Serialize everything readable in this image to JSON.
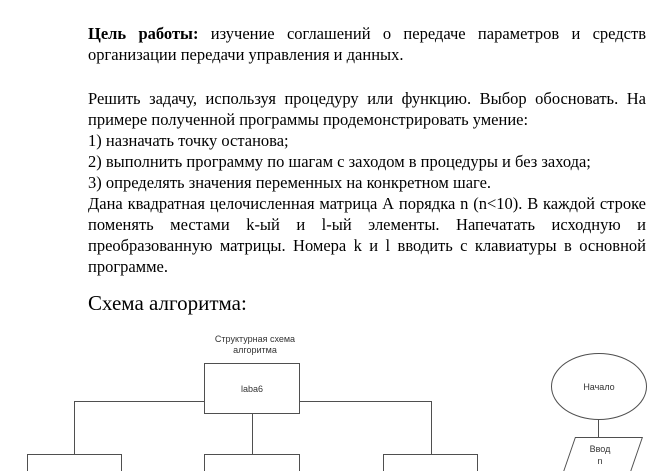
{
  "document": {
    "goal": {
      "label": "Цель работы:",
      "text": "изучение соглашений о передаче параметров и средств организации передачи управления и данных."
    },
    "task": "Решить задачу, используя процедуру или функцию. Выбор обосновать. На примере полученной программы продемонстрировать умение:",
    "steps": [
      "1) назначать точку останова;",
      "2) выполнить программу по шагам с заходом в процедуры и без захода;",
      "3) определять значения переменных на конкретном шаге."
    ],
    "matrix_task": "Дана квадратная целочисленная матрица А порядка n (n<10). В каждой строке поменять местами k-ый и l-ый элементы. Напечатать исходную и преобразованную матрицы. Номера k и l вводить с клавиатуры в основной программе.",
    "heading": "Схема алгоритма:"
  },
  "flowchart": {
    "structure_label": "Структурная схема\nалгоритма",
    "root": "laba6",
    "start": "Начало",
    "input": "Ввод\nn",
    "line_color": "#4f4f4f"
  }
}
